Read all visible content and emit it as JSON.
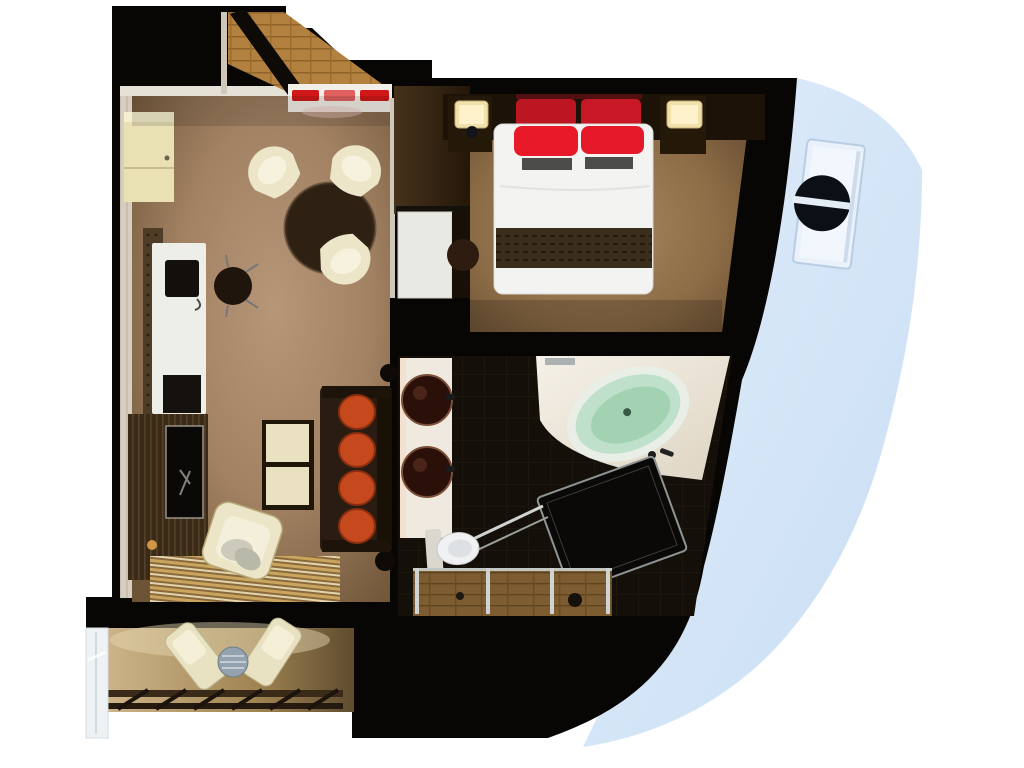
{
  "scene": {
    "title": "Cruise ship balcony stateroom floor plan (top-down 3D render)",
    "background": "#ffffff"
  },
  "colors": {
    "structure": "#080605",
    "hull": "#d2e4f7",
    "hull_recess": "#eaf1fb",
    "porthole": "#0c1016",
    "porthole_bar": "#e4edf6",
    "carpet_living": "#a08060",
    "carpet_bedroom": "#8f7048",
    "wall_light": "#e6e1d6",
    "closet": "#e9e0b4",
    "sideboard_white": "#f2efe8",
    "tray_red": "#d01818",
    "table_wood": "#2e2114",
    "chair_cream": "#ece5c8",
    "desk_white": "#edeee8",
    "laptop": "#13100b",
    "tv_screen": "#0b0908",
    "sofa": "#2a1c11",
    "cushion_orange": "#c5491d",
    "ottoman_cream": "#eae1c0",
    "bed_linen": "#f3f3f1",
    "pillow_red": "#e81a2a",
    "pillow_red_dark": "#bb1622",
    "runner_brown": "#3a2d1c",
    "headboard_wood": "#1c1207",
    "nightstand_wood": "#241808",
    "lamp_glow": "#f0e0aa",
    "stool_wood": "#2e1c10",
    "counter_white": "#efe9df",
    "sink_dark": "#2a1008",
    "tub_rim": "#e9efe7",
    "tub_mint": "#bfe0ca",
    "tub_mint_deep": "#a3d2b2",
    "toilet_white": "#eff1f2",
    "shower_dark": "#0b0908",
    "glass_frame": "#cfd4d2",
    "balcony_chair": "#e9e2c2",
    "balcony_table": "#93a2ac",
    "railing_wood": "#3a2a18",
    "glass_panel": "#eef2f4",
    "vanity_white": "#e9e9e4",
    "door_leaf": "#0d0a07"
  },
  "rooms": {
    "entry": {
      "items": [
        "entry-door",
        "wood-floor"
      ]
    },
    "living_room": {
      "items": [
        "wardrobe-closet",
        "console-with-red-trays",
        "dining-table",
        "dining-chair x3",
        "writing-desk",
        "desk-chair",
        "laptop",
        "tv-cabinet",
        "tv",
        "sofa",
        "orange-cushions x4",
        "ottoman",
        "armchair",
        "striped-rug"
      ]
    },
    "bedroom": {
      "items": [
        "double-bed",
        "red-pillows x4",
        "bed-runner",
        "headboard-unit",
        "nightstand x2",
        "lamp x2",
        "stool",
        "divider-wardrobe",
        "vanity-desk"
      ]
    },
    "bathroom": {
      "items": [
        "double-sink-counter",
        "bathtub",
        "shower-enclosure",
        "toilet",
        "glass-doors"
      ]
    },
    "balcony": {
      "items": [
        "lounge-chair x2",
        "side-table",
        "railing",
        "glass-partition"
      ]
    },
    "exterior": {
      "items": [
        "ship-hull",
        "porthole-window"
      ]
    }
  }
}
